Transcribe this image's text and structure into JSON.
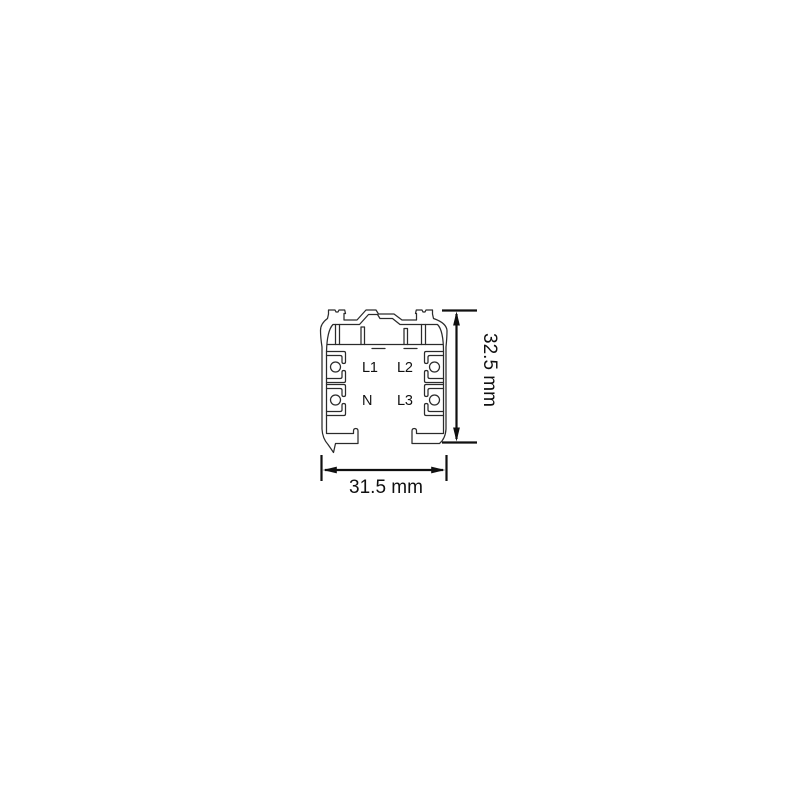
{
  "drawing": {
    "conductors": [
      {
        "label": "L1"
      },
      {
        "label": "L2"
      },
      {
        "label": "N"
      },
      {
        "label": "L3"
      }
    ],
    "dimensions": {
      "height_label": "32.5 mm",
      "width_label": "31.5 mm"
    },
    "colors": {
      "outline": "#2b2b2b",
      "dimension": "#101010",
      "background": "#ffffff"
    }
  }
}
